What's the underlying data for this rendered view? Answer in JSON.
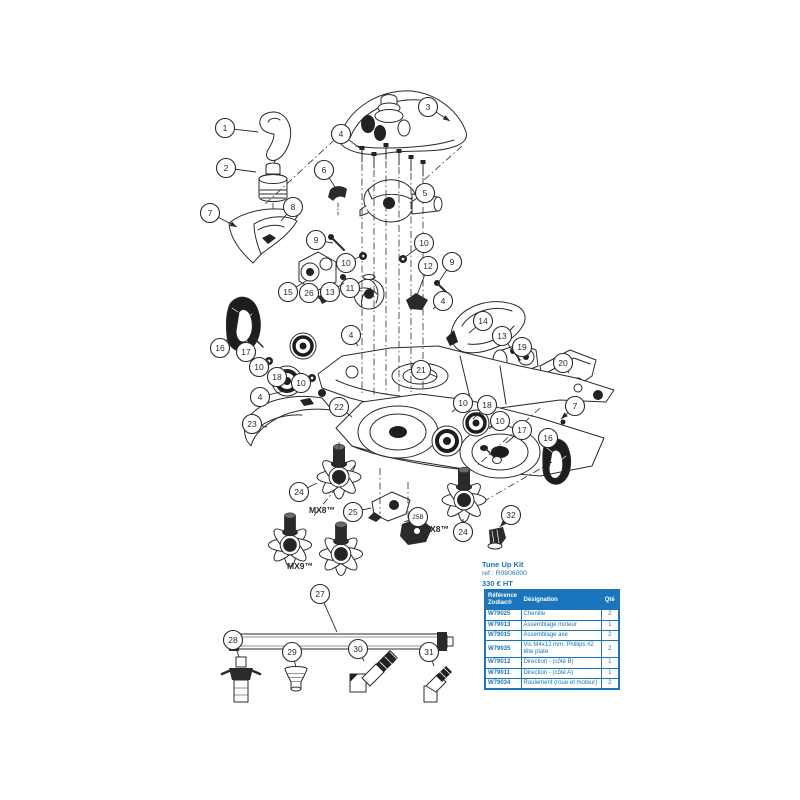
{
  "colors": {
    "accent": "#1b75bc",
    "line": "#2b2b2b"
  },
  "kit": {
    "title": "Tune Up Kit",
    "ref": "ref :  R0806000",
    "price": "330 € HT"
  },
  "table": {
    "headers": [
      "Référence Zodiac®",
      "Désignation",
      "Qté"
    ],
    "rows": [
      [
        "W79025",
        "Chenille",
        "2"
      ],
      [
        "W79013",
        "Assemblage moteur",
        "1"
      ],
      [
        "W79015",
        "Assemblage axe",
        "2"
      ],
      [
        "W79035",
        "Vis M4x12 mm, Phillips #2 tête plate",
        "2"
      ],
      [
        "W79012",
        "Direction - (côté B)",
        "1"
      ],
      [
        "W79011",
        "Direction - (côté A)",
        "1"
      ],
      [
        "W79034",
        "Roulement (roue et moteur)",
        "2"
      ]
    ]
  },
  "diagram": {
    "model_labels": [
      {
        "text": "MX8™",
        "x": 322,
        "y": 513
      },
      {
        "text": "MX9™",
        "x": 300,
        "y": 569
      },
      {
        "text": "MX8™",
        "x": 436,
        "y": 532
      }
    ],
    "callouts": [
      {
        "label": "1",
        "x": 225,
        "y": 128,
        "tx": 258,
        "ty": 132
      },
      {
        "label": "2",
        "x": 226,
        "y": 168,
        "tx": 256,
        "ty": 172
      },
      {
        "label": "3",
        "x": 428,
        "y": 107,
        "tx": 450,
        "ty": 121,
        "arrow": true
      },
      {
        "label": "4",
        "x": 341,
        "y": 134,
        "tx": 361,
        "ty": 149
      },
      {
        "label": "6",
        "x": 324,
        "y": 170,
        "tx": 335,
        "ty": 187
      },
      {
        "label": "5",
        "x": 425,
        "y": 193,
        "tx": 410,
        "ty": 203
      },
      {
        "label": "7",
        "x": 210,
        "y": 213,
        "tx": 237,
        "ty": 227,
        "arrow": true
      },
      {
        "label": "8",
        "x": 293,
        "y": 207,
        "tx": 281,
        "ty": 221
      },
      {
        "label": "9",
        "x": 316,
        "y": 240,
        "tx": 333,
        "ty": 243
      },
      {
        "label": "10",
        "x": 346,
        "y": 263,
        "tx": 361,
        "ty": 256
      },
      {
        "label": "10",
        "x": 424,
        "y": 243,
        "tx": 404,
        "ty": 258
      },
      {
        "label": "11",
        "x": 350,
        "y": 288,
        "tx": 361,
        "ty": 291
      },
      {
        "label": "12",
        "x": 428,
        "y": 266,
        "tx": 416,
        "ty": 298
      },
      {
        "label": "9",
        "x": 452,
        "y": 262,
        "tx": 438,
        "ty": 283
      },
      {
        "label": "13",
        "x": 330,
        "y": 292,
        "tx": 344,
        "ty": 283
      },
      {
        "label": "15",
        "x": 288,
        "y": 292,
        "tx": 306,
        "ty": 281
      },
      {
        "label": "26",
        "x": 309,
        "y": 293,
        "tx": 322,
        "ty": 300
      },
      {
        "label": "16",
        "x": 220,
        "y": 348,
        "tx": 233,
        "ty": 333
      },
      {
        "label": "17",
        "x": 246,
        "y": 352,
        "tx": 254,
        "ty": 341
      },
      {
        "label": "10",
        "x": 259,
        "y": 367,
        "tx": 269,
        "ty": 361
      },
      {
        "label": "18",
        "x": 277,
        "y": 377,
        "tx": 289,
        "ty": 370
      },
      {
        "label": "10",
        "x": 301,
        "y": 383,
        "tx": 311,
        "ty": 378
      },
      {
        "label": "4",
        "x": 351,
        "y": 335,
        "tx": 358,
        "ty": 346
      },
      {
        "label": "4",
        "x": 443,
        "y": 301,
        "tx": 433,
        "ty": 309
      },
      {
        "label": "14",
        "x": 483,
        "y": 321,
        "tx": 469,
        "ty": 333
      },
      {
        "label": "13",
        "x": 502,
        "y": 336,
        "tx": 513,
        "ty": 351
      },
      {
        "label": "19",
        "x": 522,
        "y": 347,
        "tx": 527,
        "ty": 357
      },
      {
        "label": "20",
        "x": 563,
        "y": 363,
        "tx": 569,
        "ty": 373
      },
      {
        "label": "21",
        "x": 421,
        "y": 370,
        "tx": 437,
        "ty": 377
      },
      {
        "label": "4",
        "x": 260,
        "y": 397,
        "tx": 288,
        "ty": 390
      },
      {
        "label": "23",
        "x": 252,
        "y": 424,
        "tx": 267,
        "ty": 427
      },
      {
        "label": "22",
        "x": 339,
        "y": 407,
        "tx": 352,
        "ty": 417
      },
      {
        "label": "10",
        "x": 463,
        "y": 403,
        "tx": 452,
        "ty": 412
      },
      {
        "label": "18",
        "x": 487,
        "y": 405,
        "tx": 473,
        "ty": 419
      },
      {
        "label": "10",
        "x": 500,
        "y": 421,
        "tx": 489,
        "ty": 429
      },
      {
        "label": "17",
        "x": 522,
        "y": 430,
        "tx": 506,
        "ty": 443
      },
      {
        "label": "16",
        "x": 548,
        "y": 438,
        "tx": 556,
        "ty": 450
      },
      {
        "label": "7",
        "x": 575,
        "y": 406,
        "tx": 561,
        "ty": 419,
        "arrow": true
      },
      {
        "label": "24",
        "x": 299,
        "y": 492,
        "tx": 317,
        "ty": 483
      },
      {
        "label": "25",
        "x": 353,
        "y": 512,
        "tx": 371,
        "ty": 508
      },
      {
        "label": "25B",
        "x": 418,
        "y": 517,
        "tx": 404,
        "ty": 522
      },
      {
        "label": "24",
        "x": 463,
        "y": 532,
        "tx": 463,
        "ty": 519
      },
      {
        "label": "32",
        "x": 511,
        "y": 515,
        "tx": 500,
        "ty": 527,
        "arrow": true
      },
      {
        "label": "27",
        "x": 320,
        "y": 594,
        "tx": 337,
        "ty": 632
      },
      {
        "label": "28",
        "x": 233,
        "y": 640,
        "tx": 239,
        "ty": 657
      },
      {
        "label": "29",
        "x": 292,
        "y": 652,
        "tx": 296,
        "ty": 667
      },
      {
        "label": "30",
        "x": 358,
        "y": 649,
        "tx": 364,
        "ty": 661
      },
      {
        "label": "31",
        "x": 429,
        "y": 652,
        "tx": 434,
        "ty": 666
      }
    ]
  }
}
